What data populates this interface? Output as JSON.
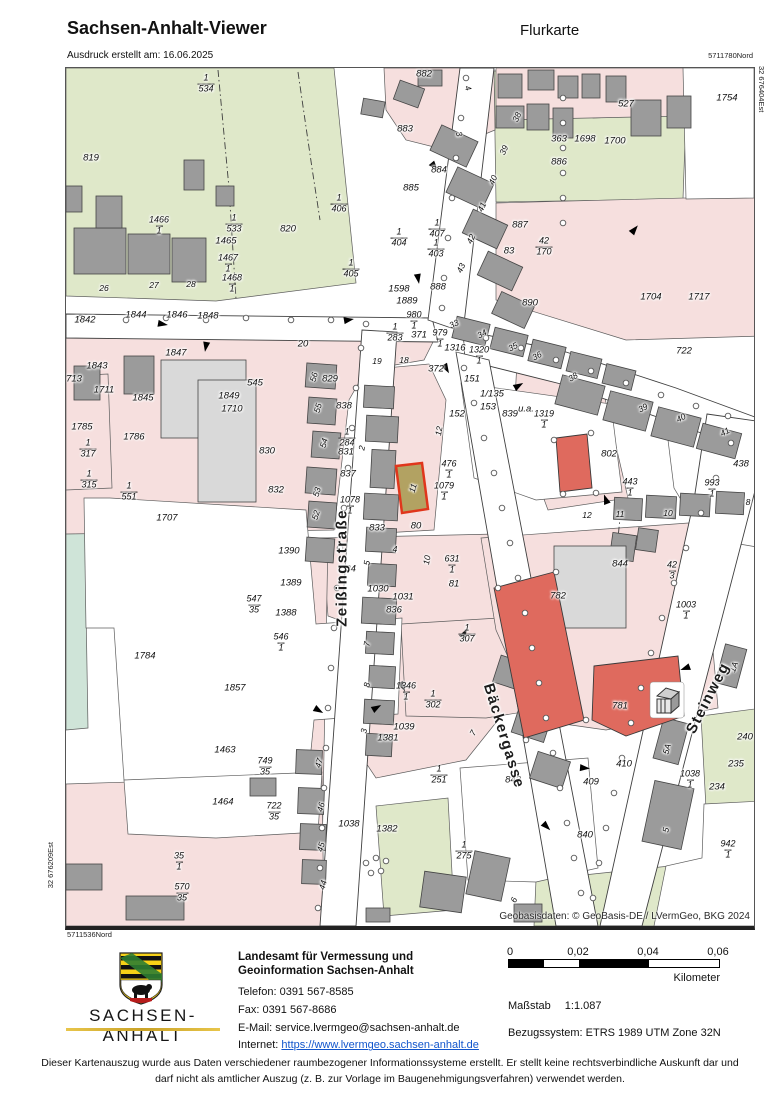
{
  "header": {
    "app_title": "Sachsen-Anhalt-Viewer",
    "map_title": "Flurkarte",
    "print_info": "Ausdruck erstellt am: 16.06.2025"
  },
  "map": {
    "frame_coords": {
      "top_right": "5711780Nord",
      "right_edge": "32 676404Est",
      "left_edge": "32 676209Est",
      "bottom_left": "5711536Nord"
    },
    "attribution": "Geobasisdaten: © GeoBasis-DE / LVermGeo, BKG 2024",
    "selected_parcel": "11",
    "streets": [
      {
        "name": "Zeißingstraße",
        "x": 276,
        "y": 500,
        "r": -90
      },
      {
        "name": "Bäckergasse",
        "x": 438,
        "y": 668,
        "r": 73
      },
      {
        "name": "Steinweg",
        "x": 642,
        "y": 630,
        "r": -63
      }
    ],
    "parcels": [
      {
        "t": "819",
        "x": 25,
        "y": 90
      },
      {
        "t": "820",
        "x": 222,
        "y": 161
      },
      {
        "t": "882",
        "x": 358,
        "y": 6
      },
      {
        "t": "883",
        "x": 339,
        "y": 61
      },
      {
        "t": "884",
        "x": 373,
        "y": 102
      },
      {
        "t": "885",
        "x": 345,
        "y": 120
      },
      {
        "t": "1598",
        "x": 333,
        "y": 221
      },
      {
        "t": "1889",
        "x": 341,
        "y": 233
      },
      {
        "t": "888",
        "x": 372,
        "y": 219
      },
      {
        "t": "371",
        "x": 353,
        "y": 267
      },
      {
        "t": "1316",
        "x": 389,
        "y": 280
      },
      {
        "t": "372",
        "x": 370,
        "y": 301
      },
      {
        "t": "151",
        "x": 406,
        "y": 311
      },
      {
        "t": "1/135",
        "x": 426,
        "y": 326
      },
      {
        "t": "153",
        "x": 422,
        "y": 339
      },
      {
        "t": "152",
        "x": 391,
        "y": 346
      },
      {
        "t": "839",
        "x": 444,
        "y": 346
      },
      {
        "t": "u.a.",
        "x": 460,
        "y": 341
      },
      {
        "t": "890",
        "x": 464,
        "y": 235
      },
      {
        "t": "887",
        "x": 454,
        "y": 157
      },
      {
        "t": "83",
        "x": 443,
        "y": 183
      },
      {
        "t": "363",
        "x": 493,
        "y": 71
      },
      {
        "t": "1698",
        "x": 519,
        "y": 71
      },
      {
        "t": "1700",
        "x": 549,
        "y": 73
      },
      {
        "t": "886",
        "x": 493,
        "y": 94
      },
      {
        "t": "527",
        "x": 560,
        "y": 36
      },
      {
        "t": "1754",
        "x": 661,
        "y": 30
      },
      {
        "t": "1704",
        "x": 585,
        "y": 229
      },
      {
        "t": "1717",
        "x": 633,
        "y": 229
      },
      {
        "t": "722",
        "x": 618,
        "y": 283
      },
      {
        "t": "802",
        "x": 543,
        "y": 386
      },
      {
        "t": "438",
        "x": 675,
        "y": 396
      },
      {
        "t": "1842",
        "x": 19,
        "y": 252
      },
      {
        "t": "1844",
        "x": 70,
        "y": 247
      },
      {
        "t": "1846",
        "x": 111,
        "y": 247
      },
      {
        "t": "1848",
        "x": 142,
        "y": 248
      },
      {
        "t": "1843",
        "x": 31,
        "y": 298
      },
      {
        "t": "1847",
        "x": 110,
        "y": 285
      },
      {
        "t": "713",
        "x": 8,
        "y": 311
      },
      {
        "t": "1711",
        "x": 38,
        "y": 322
      },
      {
        "t": "1845",
        "x": 77,
        "y": 330
      },
      {
        "t": "1849",
        "x": 163,
        "y": 328
      },
      {
        "t": "1710",
        "x": 166,
        "y": 341
      },
      {
        "t": "545",
        "x": 189,
        "y": 315
      },
      {
        "t": "1785",
        "x": 16,
        "y": 359
      },
      {
        "t": "1786",
        "x": 68,
        "y": 369
      },
      {
        "t": "1707",
        "x": 101,
        "y": 450
      },
      {
        "t": "830",
        "x": 201,
        "y": 383
      },
      {
        "t": "832",
        "x": 210,
        "y": 422
      },
      {
        "t": "829",
        "x": 264,
        "y": 311
      },
      {
        "t": "838",
        "x": 278,
        "y": 338
      },
      {
        "t": "831",
        "x": 280,
        "y": 384
      },
      {
        "t": "837",
        "x": 282,
        "y": 406
      },
      {
        "t": "833",
        "x": 311,
        "y": 460
      },
      {
        "t": "80",
        "x": 350,
        "y": 458
      },
      {
        "t": "1390",
        "x": 223,
        "y": 483
      },
      {
        "t": "1389",
        "x": 225,
        "y": 515
      },
      {
        "t": "1388",
        "x": 220,
        "y": 545
      },
      {
        "t": "1784",
        "x": 79,
        "y": 588
      },
      {
        "t": "1857",
        "x": 169,
        "y": 620
      },
      {
        "t": "834",
        "x": 282,
        "y": 501
      },
      {
        "t": "1030",
        "x": 312,
        "y": 521
      },
      {
        "t": "1031",
        "x": 337,
        "y": 529
      },
      {
        "t": "836",
        "x": 328,
        "y": 542
      },
      {
        "t": "81",
        "x": 388,
        "y": 516
      },
      {
        "t": "1039",
        "x": 338,
        "y": 659
      },
      {
        "t": "1381",
        "x": 322,
        "y": 670
      },
      {
        "t": "782",
        "x": 492,
        "y": 528
      },
      {
        "t": "844",
        "x": 554,
        "y": 496
      },
      {
        "t": "781",
        "x": 554,
        "y": 638
      },
      {
        "t": "240",
        "x": 679,
        "y": 669
      },
      {
        "t": "235",
        "x": 670,
        "y": 696
      },
      {
        "t": "234",
        "x": 651,
        "y": 719
      },
      {
        "t": "410",
        "x": 558,
        "y": 696
      },
      {
        "t": "409",
        "x": 525,
        "y": 714
      },
      {
        "t": "840",
        "x": 519,
        "y": 767
      },
      {
        "t": "1463",
        "x": 159,
        "y": 682
      },
      {
        "t": "1464",
        "x": 157,
        "y": 734
      },
      {
        "t": "1382",
        "x": 321,
        "y": 761
      },
      {
        "t": "1038",
        "x": 283,
        "y": 756
      },
      {
        "t": "843",
        "x": 447,
        "y": 712
      },
      {
        "t": "20",
        "x": 237,
        "y": 276
      },
      {
        "t": "1465",
        "x": 160,
        "y": 173
      }
    ],
    "fractions": [
      {
        "n": "1",
        "d": "534",
        "x": 140,
        "y": 16
      },
      {
        "n": "1466",
        "d": "1",
        "x": 93,
        "y": 158
      },
      {
        "n": "1",
        "d": "533",
        "x": 168,
        "y": 156
      },
      {
        "n": "1467",
        "d": "1",
        "x": 162,
        "y": 196
      },
      {
        "n": "1468",
        "d": "1",
        "x": 166,
        "y": 216
      },
      {
        "n": "1",
        "d": "406",
        "x": 273,
        "y": 136
      },
      {
        "n": "1",
        "d": "407",
        "x": 371,
        "y": 161
      },
      {
        "n": "1",
        "d": "404",
        "x": 333,
        "y": 170
      },
      {
        "n": "1",
        "d": "403",
        "x": 370,
        "y": 181
      },
      {
        "n": "1",
        "d": "405",
        "x": 285,
        "y": 201
      },
      {
        "n": "980",
        "d": "1",
        "x": 348,
        "y": 253
      },
      {
        "n": "1",
        "d": "283",
        "x": 329,
        "y": 265
      },
      {
        "n": "979",
        "d": "1",
        "x": 374,
        "y": 271
      },
      {
        "n": "1320",
        "d": "1",
        "x": 413,
        "y": 288
      },
      {
        "n": "1319",
        "d": "1",
        "x": 478,
        "y": 352
      },
      {
        "n": "42",
        "d": "170",
        "x": 478,
        "y": 179
      },
      {
        "n": "1",
        "d": "317",
        "x": 22,
        "y": 381
      },
      {
        "n": "1",
        "d": "315",
        "x": 23,
        "y": 412
      },
      {
        "n": "1",
        "d": "551",
        "x": 63,
        "y": 424
      },
      {
        "n": "1",
        "d": "284",
        "x": 281,
        "y": 370
      },
      {
        "n": "1078",
        "d": "1",
        "x": 284,
        "y": 438
      },
      {
        "n": "476",
        "d": "1",
        "x": 383,
        "y": 402
      },
      {
        "n": "1079",
        "d": "1",
        "x": 378,
        "y": 424
      },
      {
        "n": "546",
        "d": "1",
        "x": 215,
        "y": 575
      },
      {
        "n": "547",
        "d": "35",
        "x": 188,
        "y": 537
      },
      {
        "n": "631",
        "d": "1",
        "x": 386,
        "y": 497
      },
      {
        "n": "1",
        "d": "307",
        "x": 401,
        "y": 566
      },
      {
        "n": "1346",
        "d": "1",
        "x": 340,
        "y": 624
      },
      {
        "n": "1",
        "d": "302",
        "x": 367,
        "y": 632
      },
      {
        "n": "42",
        "d": "3",
        "x": 606,
        "y": 503
      },
      {
        "n": "1003",
        "d": "1",
        "x": 620,
        "y": 543
      },
      {
        "n": "443",
        "d": "1",
        "x": 564,
        "y": 420
      },
      {
        "n": "993",
        "d": "1",
        "x": 646,
        "y": 421
      },
      {
        "n": "942",
        "d": "1",
        "x": 662,
        "y": 782
      },
      {
        "n": "1038",
        "d": "1",
        "x": 624,
        "y": 712
      },
      {
        "n": "749",
        "d": "35",
        "x": 199,
        "y": 699
      },
      {
        "n": "722",
        "d": "35",
        "x": 208,
        "y": 744
      },
      {
        "n": "35",
        "d": "1",
        "x": 113,
        "y": 794
      },
      {
        "n": "570",
        "d": "35",
        "x": 116,
        "y": 825
      },
      {
        "n": "1",
        "d": "251",
        "x": 373,
        "y": 707
      },
      {
        "n": "1",
        "d": "275",
        "x": 398,
        "y": 783
      }
    ],
    "house_numbers": [
      {
        "t": "26",
        "x": 38,
        "y": 220,
        "r": 0
      },
      {
        "t": "27",
        "x": 88,
        "y": 217,
        "r": 0
      },
      {
        "t": "28",
        "x": 125,
        "y": 216,
        "r": 0
      },
      {
        "t": "4",
        "x": 402,
        "y": 20,
        "r": 70
      },
      {
        "t": "3",
        "x": 393,
        "y": 66,
        "r": 70
      },
      {
        "t": "38",
        "x": 451,
        "y": 49,
        "r": -65
      },
      {
        "t": "39",
        "x": 438,
        "y": 82,
        "r": -65
      },
      {
        "t": "40",
        "x": 427,
        "y": 112,
        "r": -65
      },
      {
        "t": "41",
        "x": 416,
        "y": 139,
        "r": -65
      },
      {
        "t": "42",
        "x": 405,
        "y": 171,
        "r": -65
      },
      {
        "t": "43",
        "x": 395,
        "y": 200,
        "r": -65
      },
      {
        "t": "33",
        "x": 388,
        "y": 256,
        "r": -25
      },
      {
        "t": "34",
        "x": 416,
        "y": 266,
        "r": -28
      },
      {
        "t": "35",
        "x": 447,
        "y": 279,
        "r": -28
      },
      {
        "t": "36",
        "x": 471,
        "y": 288,
        "r": -28
      },
      {
        "t": "38",
        "x": 507,
        "y": 309,
        "r": -32
      },
      {
        "t": "39",
        "x": 577,
        "y": 340,
        "r": -28
      },
      {
        "t": "40",
        "x": 615,
        "y": 350,
        "r": -28
      },
      {
        "t": "41",
        "x": 659,
        "y": 364,
        "r": -28
      },
      {
        "t": "19",
        "x": 311,
        "y": 293,
        "r": 0
      },
      {
        "t": "18",
        "x": 338,
        "y": 292,
        "r": 0
      },
      {
        "t": "56",
        "x": 248,
        "y": 309,
        "r": -75
      },
      {
        "t": "55",
        "x": 252,
        "y": 340,
        "r": -75
      },
      {
        "t": "54",
        "x": 258,
        "y": 375,
        "r": -75
      },
      {
        "t": "53",
        "x": 251,
        "y": 424,
        "r": -75
      },
      {
        "t": "52",
        "x": 250,
        "y": 447,
        "r": -75
      },
      {
        "t": "12",
        "x": 521,
        "y": 447,
        "r": 0
      },
      {
        "t": "11",
        "x": 554,
        "y": 446,
        "r": 0
      },
      {
        "t": "10",
        "x": 602,
        "y": 445,
        "r": 0
      },
      {
        "t": "8",
        "x": 682,
        "y": 434,
        "r": 0
      },
      {
        "t": "12",
        "x": 373,
        "y": 363,
        "r": -80
      },
      {
        "t": "47",
        "x": 253,
        "y": 695,
        "r": -75
      },
      {
        "t": "46",
        "x": 255,
        "y": 739,
        "r": -75
      },
      {
        "t": "45",
        "x": 255,
        "y": 779,
        "r": -75
      },
      {
        "t": "44",
        "x": 257,
        "y": 817,
        "r": -75
      },
      {
        "t": "6",
        "x": 448,
        "y": 832,
        "r": -65
      },
      {
        "t": "5",
        "x": 600,
        "y": 762,
        "r": -80
      },
      {
        "t": "5A",
        "x": 601,
        "y": 681,
        "r": -75
      },
      {
        "t": "1A",
        "x": 668,
        "y": 599,
        "r": -70
      },
      {
        "t": "7",
        "x": 407,
        "y": 665,
        "r": -60
      },
      {
        "t": "11",
        "x": 347,
        "y": 420,
        "r": -75
      },
      {
        "t": "2",
        "x": 296,
        "y": 380,
        "r": -80
      },
      {
        "t": "10",
        "x": 361,
        "y": 492,
        "r": -80
      },
      {
        "t": "5",
        "x": 301,
        "y": 495,
        "r": -80
      },
      {
        "t": "4",
        "x": 329,
        "y": 481,
        "r": 0
      },
      {
        "t": "3",
        "x": 298,
        "y": 663,
        "r": -80
      },
      {
        "t": "8",
        "x": 301,
        "y": 617,
        "r": -80
      },
      {
        "t": "7",
        "x": 301,
        "y": 576,
        "r": -80
      }
    ]
  },
  "footer": {
    "logo_text": "SACHSEN-ANHALT",
    "agency_line1": "Landesamt für Vermessung und",
    "agency_line2": "Geoinformation Sachsen-Anhalt",
    "phone": "Telefon: 0391 567-8585",
    "fax": "Fax: 0391 567-8686",
    "email_label": "E-Mail:",
    "email": "service.lvermgeo@sachsen-anhalt.de",
    "internet_label": "Internet:",
    "internet_url": "https://www.lvermgeo.sachsen-anhalt.de"
  },
  "legend": {
    "scale_ticks": [
      "0",
      "0,02",
      "0,04",
      "0,06"
    ],
    "scale_unit": "Kilometer",
    "scale_label": "Maßstab",
    "scale_value": "1:1.087",
    "crs_line": "Bezugssystem: ETRS 1989 UTM Zone 32N"
  },
  "disclaimer": "Dieser Kartenauszug wurde aus Daten verschiedener raumbezogener Informationssysteme erstellt. Er stellt keine rechtsverbindliche Auskunft dar und darf nicht als amtlicher Auszug (z. B. zur Vorlage im Baugenehmigungsverfahren) verwendet werden.",
  "colors": {
    "green": "#dfe8c9",
    "teal": "#cfe4d8",
    "pink": "#f6dfde",
    "building_gray": "#9b9b9b",
    "highlight_red": "#df6a5e",
    "selected_outline": "#e0361c",
    "link_blue": "#1155cc",
    "gold": "#c9a227"
  }
}
